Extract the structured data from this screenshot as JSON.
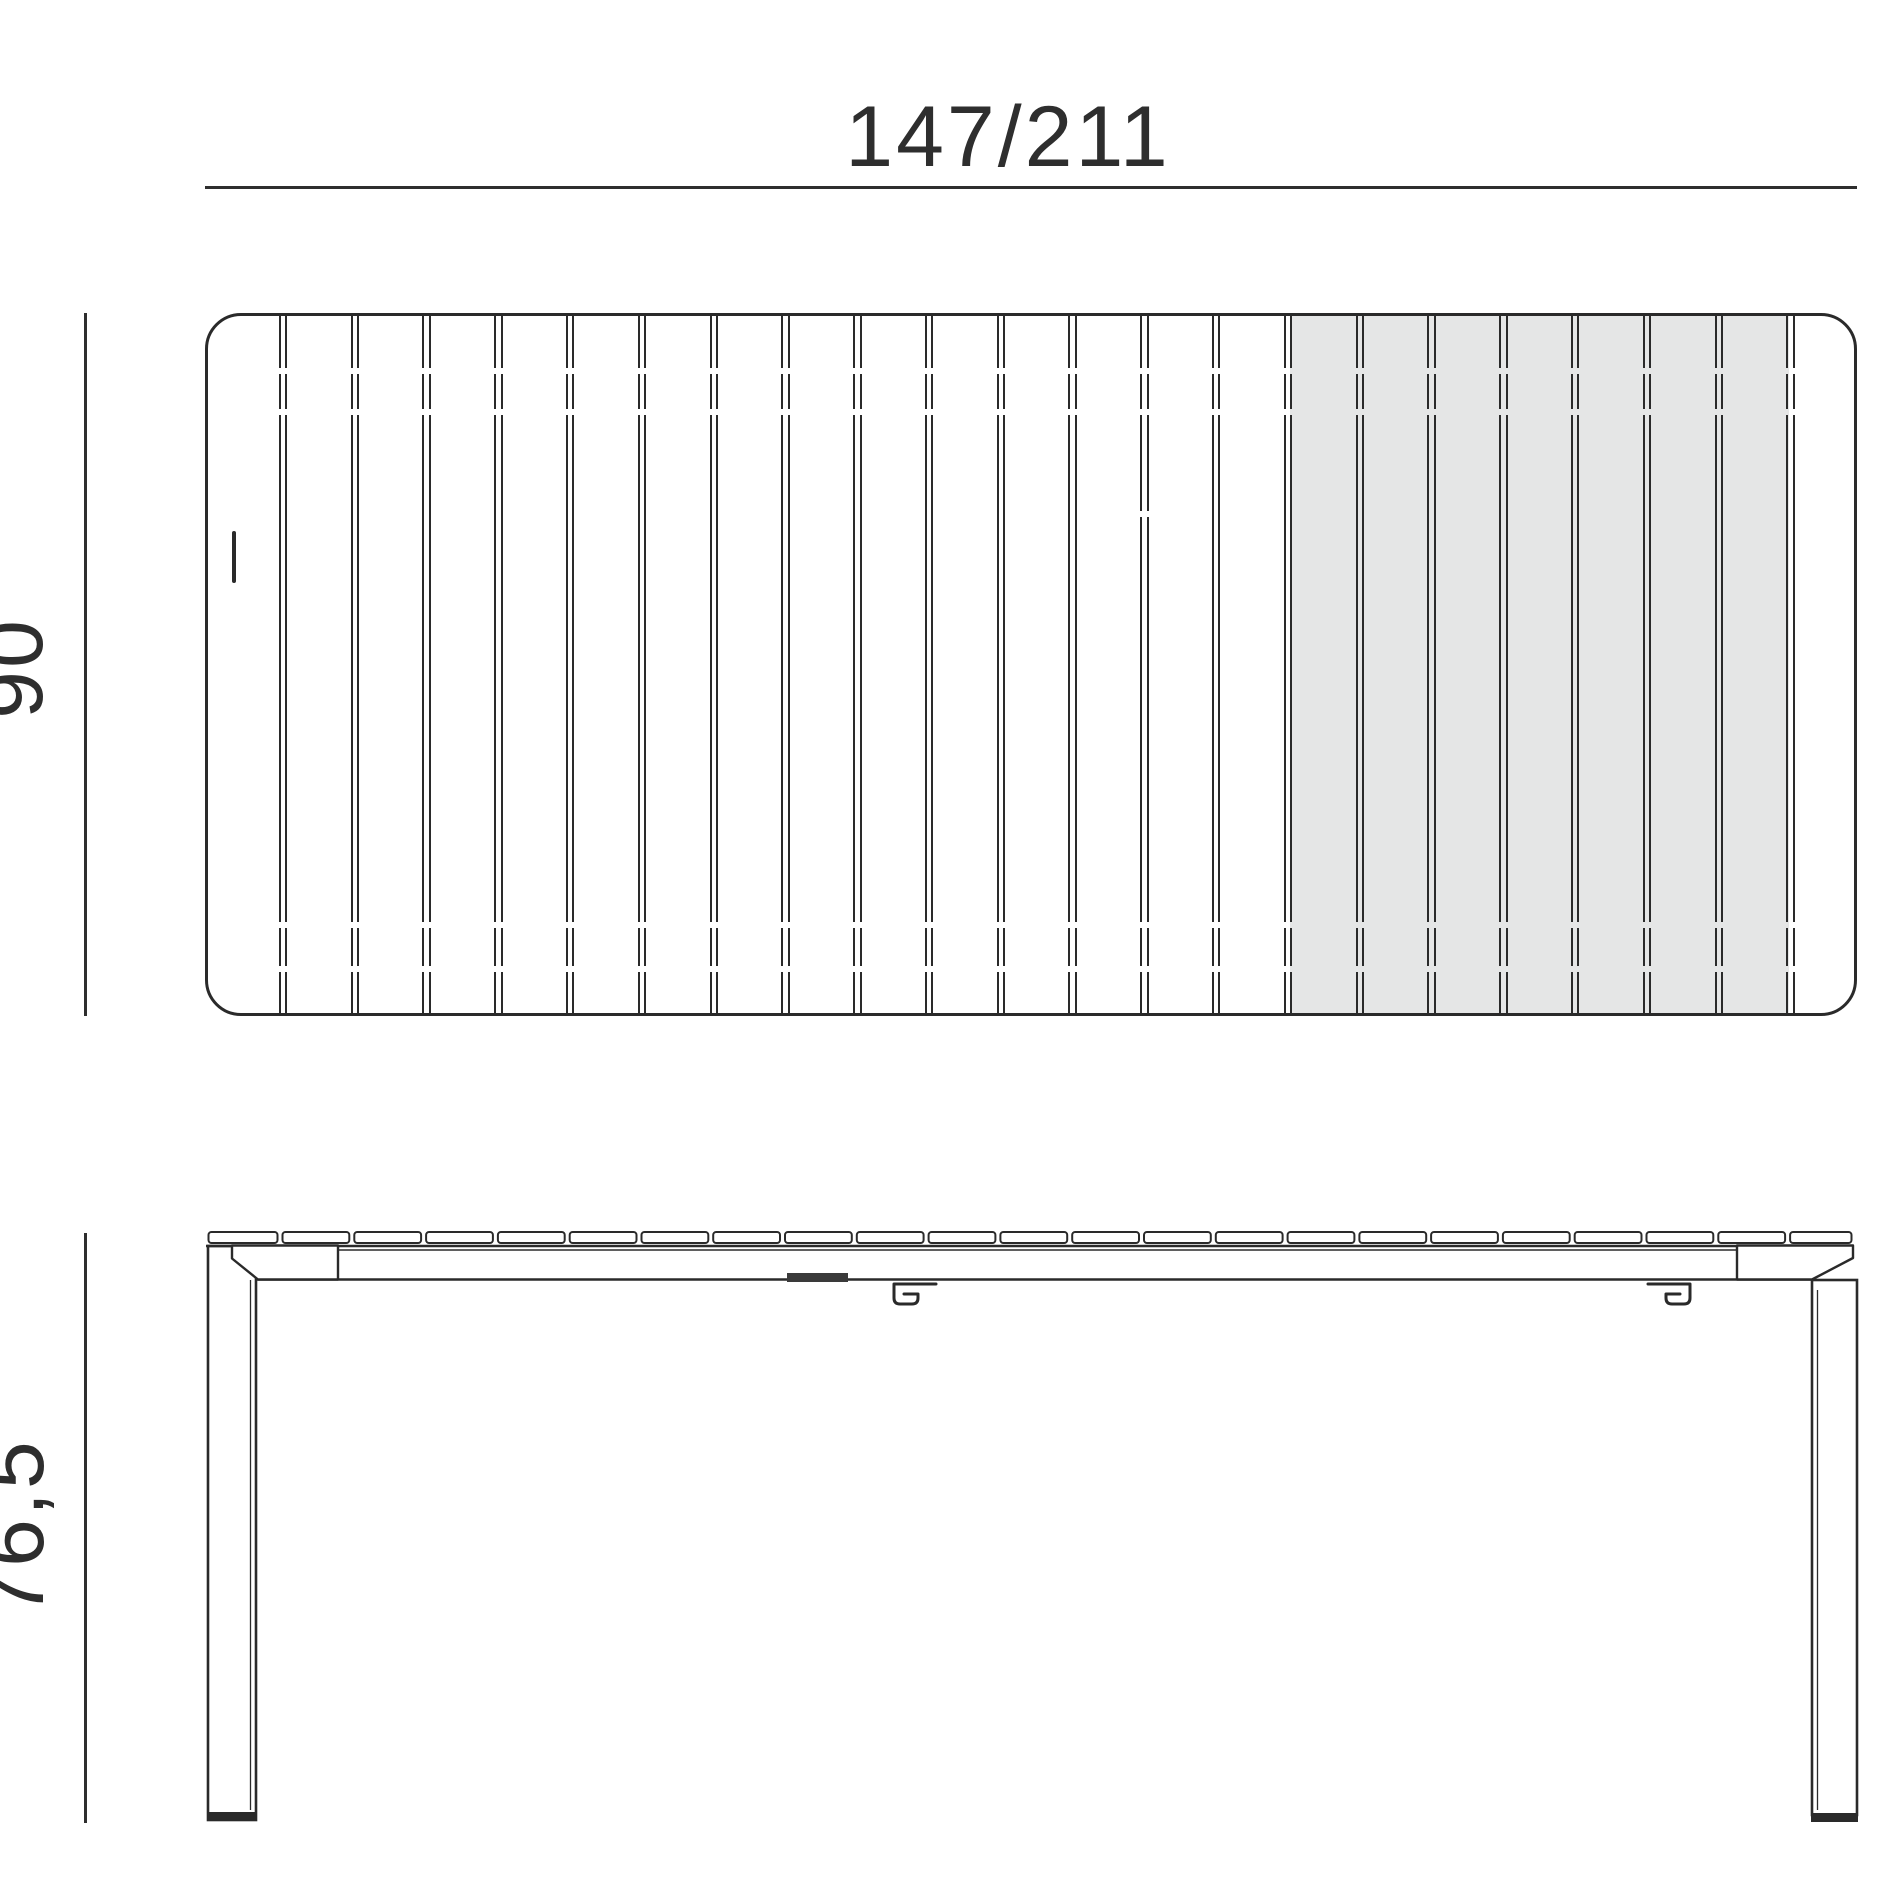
{
  "dimensions": {
    "width": "147/211",
    "depth": "90",
    "height": "76,5"
  },
  "colors": {
    "line": "#2a2a2a",
    "dim_text": "#2e2e2e",
    "extension_fill": "#e5e6e6",
    "background": "#ffffff"
  },
  "structure": {
    "top_view": {
      "slat_count": 23,
      "separator_count": 22,
      "extension_slat_count": 7,
      "extension_from_separator": 15,
      "extension_to_separator": 22
    },
    "side_view": {
      "slat_segment_count": 23,
      "leg_count": 2,
      "latch_hook_count": 2
    }
  }
}
